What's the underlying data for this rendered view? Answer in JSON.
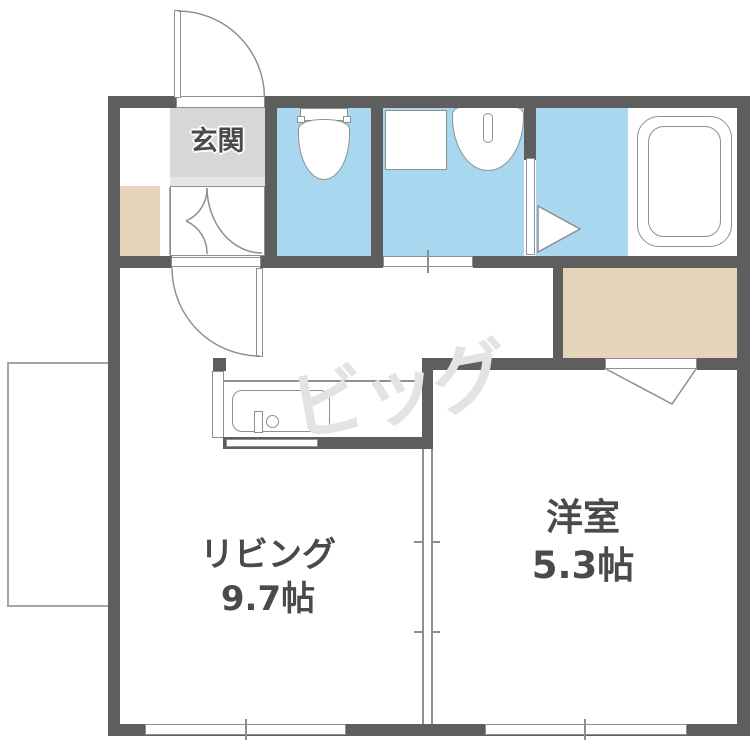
{
  "watermark": "ビッグ",
  "rooms": {
    "entrance": {
      "label": "玄関"
    },
    "living": {
      "label": "リビング",
      "size": "9.7帖"
    },
    "western": {
      "label": "洋室",
      "size": "5.3帖"
    }
  },
  "colors": {
    "wall": "#5e5e5e",
    "water_blue": "#a9d7f0",
    "closet_tan": "#e6d4ba",
    "entrance_gray": "#d7d7d7",
    "entrance_step_gray": "#e4e4e4",
    "fixture_line": "#8f8f8f",
    "label_text": "#4a4a4a",
    "watermark_gray": "#e3e3e3",
    "balcony_line": "#a5a5a5"
  }
}
